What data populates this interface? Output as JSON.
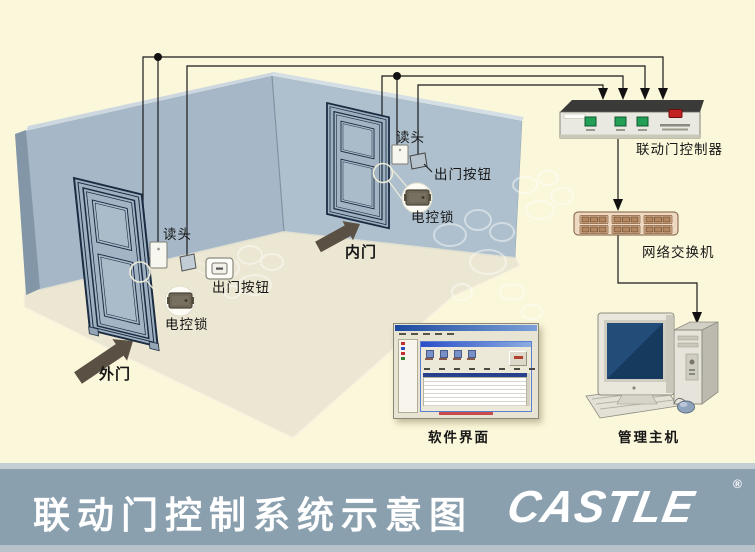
{
  "scene": {
    "outer_door": {
      "door_label": "外门",
      "reader_label": "读头",
      "exit_button_label": "出门按钮",
      "lock_label": "电控锁"
    },
    "inner_door": {
      "door_label": "内门",
      "reader_label": "读头",
      "exit_button_label": "出门按钮",
      "lock_label": "电控锁"
    },
    "controller_label": "联动门控制器",
    "switch_label": "网络交换机",
    "software_label": "软件界面",
    "host_label": "管理主机"
  },
  "footer": {
    "title": "联动门控制系统示意图",
    "brand": "CASTLE",
    "registered_mark": "®"
  },
  "colors": {
    "background": "#fbf7da",
    "wall_left": "#a6b8c8",
    "wall_right": "#aec0cd",
    "floor": "#ece7d2",
    "footer_bar": "#8ba0af",
    "wire": "#1a1a1a",
    "controller_led_green": "#21a055",
    "controller_power_red": "#c22222",
    "switch_body": "#eed9c2",
    "monitor_screen": "#16395e"
  }
}
